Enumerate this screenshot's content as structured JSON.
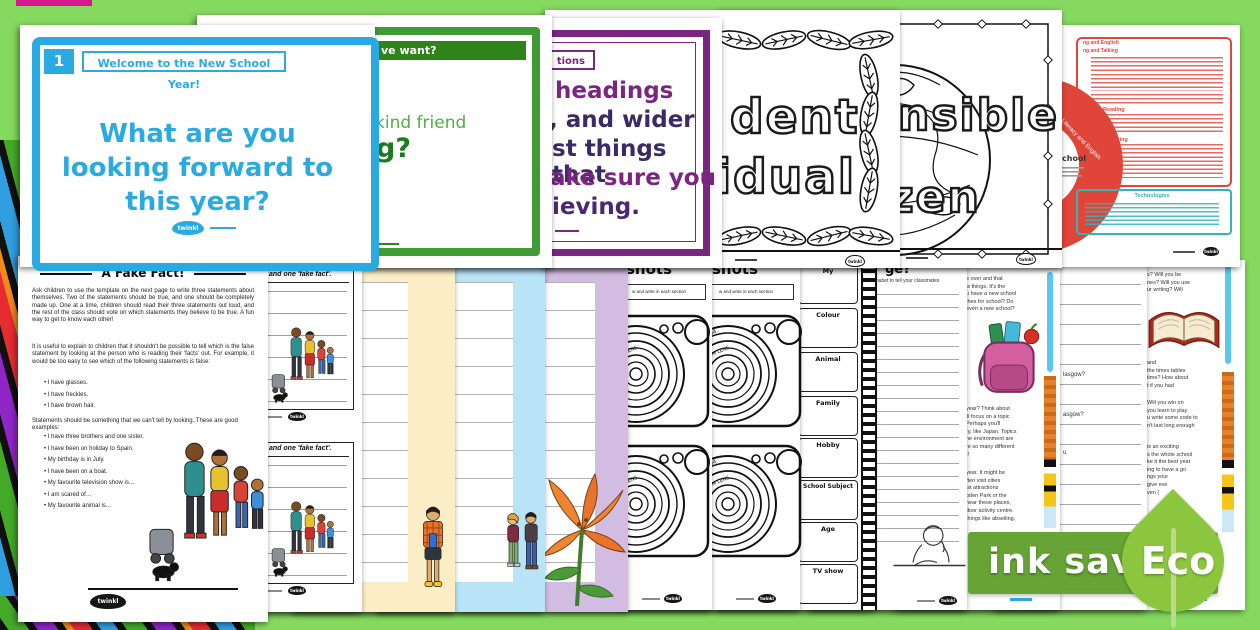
{
  "brand": {
    "logo_text": "twinkl"
  },
  "badge": {
    "label": "ink saving",
    "eco_label": "Eco",
    "banner_color": "#63a233",
    "leaf_color": "#8cc63f"
  },
  "slides": {
    "welcome": {
      "number": "1",
      "header": "Welcome to the New School Year!",
      "question": "What are you looking forward to this year?",
      "accent": "#29abe2"
    },
    "green": {
      "header_fragment": "ve want?",
      "line1": "kind friend",
      "line2": "g?",
      "accent": "#3f9c35"
    },
    "purple": {
      "header_fragment": "tions",
      "lines": [
        "headings",
        ", and wider",
        "st things that",
        "ake sure you",
        "ieving."
      ],
      "accent": "#7b2482"
    },
    "doodle_individual": {
      "line1": "dent",
      "line2": "idual"
    },
    "doodle_citizen": {
      "line1": "nsible",
      "line2": "zen"
    },
    "curriculum": {
      "heading1_fragment": "ng and English",
      "heading2_fragment": "ng and Talking",
      "reading_label": "Reading",
      "writing_label": "Writing",
      "technologies_label": "Technologies",
      "donut_label": "Literacy and English",
      "donut_center_fragment": "chool",
      "accent_red": "#e0453a",
      "accent_teal": "#2fb5ba"
    }
  },
  "worksheets": {
    "fake_fact": {
      "title": "A Fake Fact!",
      "para1": "Ask children to use the template on the next page to write three statements about themselves. Two of the statements should be true, and one should be completely made up. One at a time, children should read their three statements out loud, and the rest of the class should vote on which statements they believe to be true. A fun way to get to know each other!",
      "para2": "It is useful to explain to children that it shouldn't be possible to tell which is the false statement by looking at the person who is reading their 'facts' out. For example, it would be too easy to see which of the following statements is false:",
      "bullets_looks": [
        "I have glasses.",
        "I have freckles.",
        "I have brown hair."
      ],
      "para3": "Statements should be something that we can't tell by looking. These are good examples:",
      "bullets_examples": [
        "I have three brothers and one sister.",
        "I have been on holiday to Spain.",
        "My birthday is in July.",
        "I have been on a boat.",
        "My favourite television show is…",
        "I am scared of…",
        "My favourite animal is…"
      ]
    },
    "template": {
      "heading_fragment": "and one 'fake fact'."
    },
    "snapshots": {
      "title_fragment": "shots",
      "instruction_fragment": "w and write in each section",
      "lens_fragment1": "AL ZOOM",
      "lens_fragment2": "ZOOM LENS"
    },
    "filmstrip": {
      "top_fragment": "My",
      "labels": [
        "Colour",
        "Animal",
        "Family",
        "Hobby",
        "School Subject",
        "Age",
        "TV show"
      ]
    },
    "alphabet": {
      "title_fragment": "ge?",
      "subtitle_fragment": "lphabet to tell your classmates"
    },
    "new_year_text": {
      "para1": [
        "e over and that",
        "w things. It's the",
        "u have a new school",
        "thes for school? Do",
        "even a new school?"
      ],
      "para2": [
        "year? Think about",
        "'ll focus on a topic",
        "Perhaps you'll",
        "ry, like Japan. Topics",
        "he environment are",
        "re so many different",
        "t!"
      ],
      "para3": [
        "year. It might be",
        "ften visit cities",
        "ist attractions",
        "oden Park or the",
        "near these places,",
        "door activity centre.",
        "things like abseiling,"
      ]
    },
    "questions": {
      "fragments": [
        "lasgow?",
        "asgow?",
        "u"
      ]
    },
    "book_text": {
      "para1": [
        "s? Will you be",
        "nes? Will you use",
        "ur writing? Will"
      ],
      "para2": [
        "and",
        "the times tables",
        "time? How about",
        "t if you had"
      ],
      "para3": [
        "Will you win on",
        "you learn to play",
        "u write some code to",
        "n't last long enough"
      ],
      "para4": [
        "is an exciting",
        "s the whole school",
        "ke it the best year",
        "ing to have a go",
        "ngs your",
        "give eve",
        "ven ("
      ]
    }
  }
}
